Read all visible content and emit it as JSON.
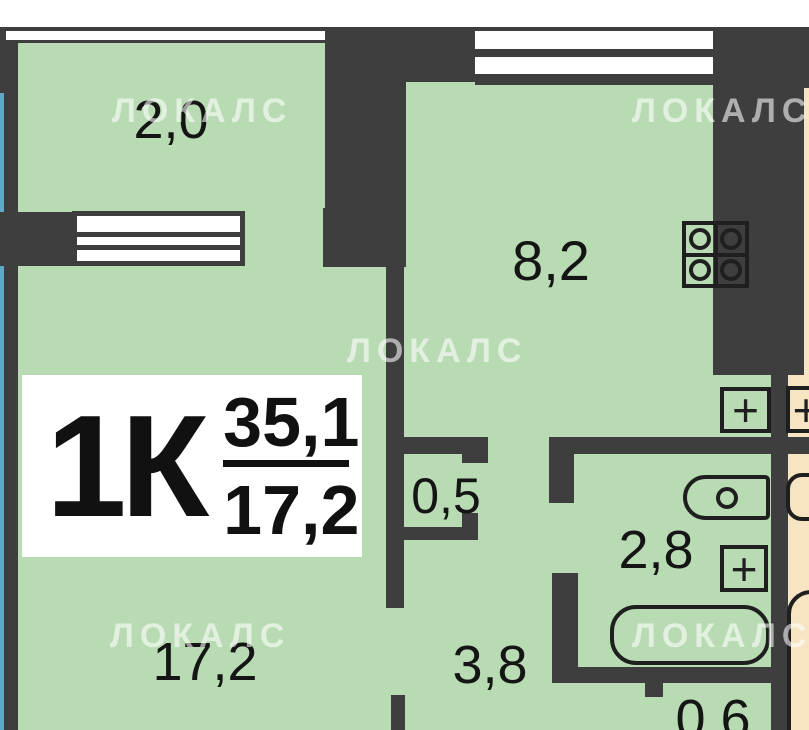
{
  "watermark": {
    "text": "ЛОКАЛС"
  },
  "legend": {
    "type_label": "1К",
    "total_area": "35,1",
    "living_area": "17,2"
  },
  "rooms": {
    "balcony": "2,0",
    "kitchen": "8,2",
    "closet": "0,5",
    "bathroom": "2,8",
    "hallway": "3,8",
    "living_room": "17,2",
    "storage": "0,6"
  },
  "icons": {
    "plus": "+"
  },
  "colors": {
    "wall": "#3e3e3e",
    "room_fill": "#b9dbb3",
    "adjacent_unit_fill": "#f6e4c3",
    "glazing_blue": "#5fa8c7",
    "fixture_line": "#1f1f1f",
    "watermark": "rgba(255,255,255,0.58)"
  }
}
